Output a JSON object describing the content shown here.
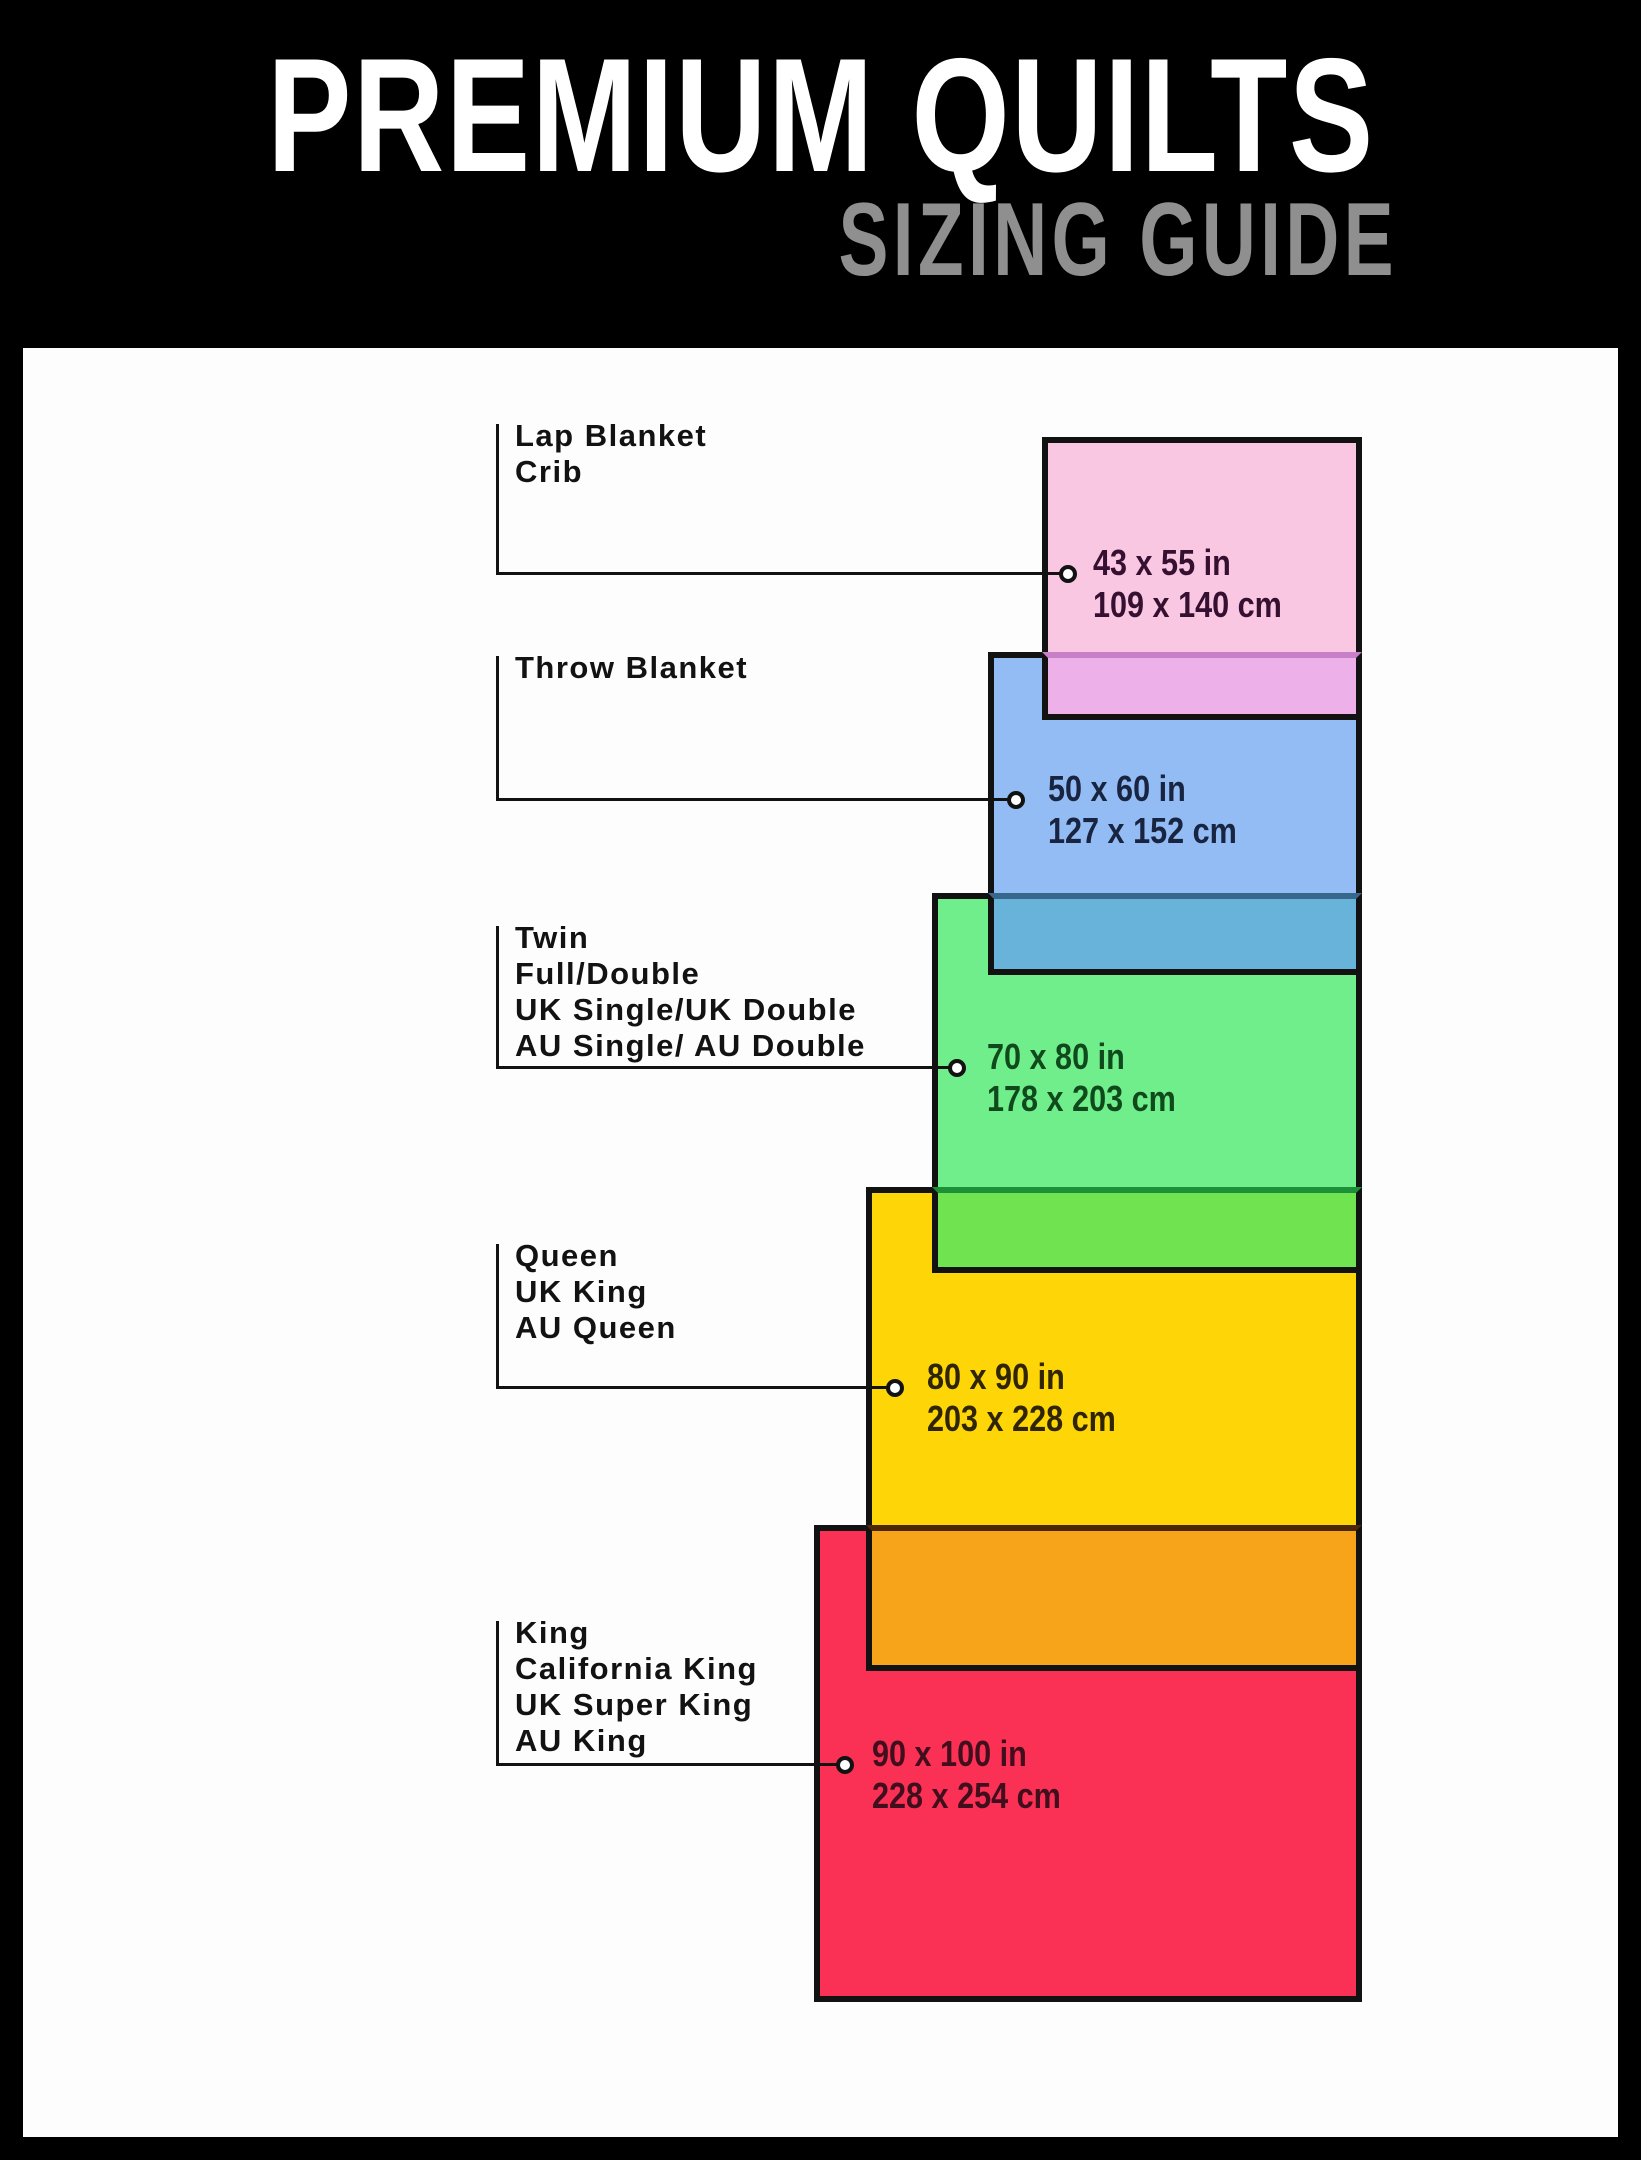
{
  "header": {
    "title": "PREMIUM QUILTS",
    "subtitle": "SIZING GUIDE",
    "bg_color": "#000000",
    "title_color": "#ffffff",
    "subtitle_color": "#8f8f8f"
  },
  "quilts": [
    {
      "id": "lap-blanket-crib",
      "label_lines": [
        "Lap Blanket",
        "Crib"
      ],
      "size_in": "43 x 55 in",
      "size_cm": "109 x 140 cm",
      "fill": "#f9c7e2",
      "overlap_fill": "#eeb0e9",
      "text_color": "#351031"
    },
    {
      "id": "throw-blanket",
      "label_lines": [
        "Throw Blanket"
      ],
      "size_in": "50 x 60 in",
      "size_cm": "127 x 152 cm",
      "fill": "#92bcf3",
      "overlap_fill": "#68b3d9",
      "text_color": "#182440"
    },
    {
      "id": "twin-full-double",
      "label_lines": [
        "Twin",
        "Full/Double",
        "UK Single/UK Double",
        "AU Single/ AU Double"
      ],
      "size_in": "70 x 80 in",
      "size_cm": "178 x 203 cm",
      "fill": "#70ee8c",
      "overlap_fill": "#6fe350",
      "text_color": "#104a1c"
    },
    {
      "id": "queen",
      "label_lines": [
        "Queen",
        "UK King",
        "AU Queen"
      ],
      "size_in": "80 x 90 in",
      "size_cm": "203 x 228 cm",
      "fill": "#fed608",
      "overlap_fill": "#f7a41a",
      "text_color": "#2f2503"
    },
    {
      "id": "king",
      "label_lines": [
        "King",
        "California King",
        "UK Super King",
        "AU King"
      ],
      "size_in": "90 x 100 in",
      "size_cm": "228 x 254 cm",
      "fill": "#fa3155",
      "overlap_fill": "",
      "text_color": "#400e1c"
    }
  ],
  "frame_color": "#000000",
  "line_color": "#121212"
}
